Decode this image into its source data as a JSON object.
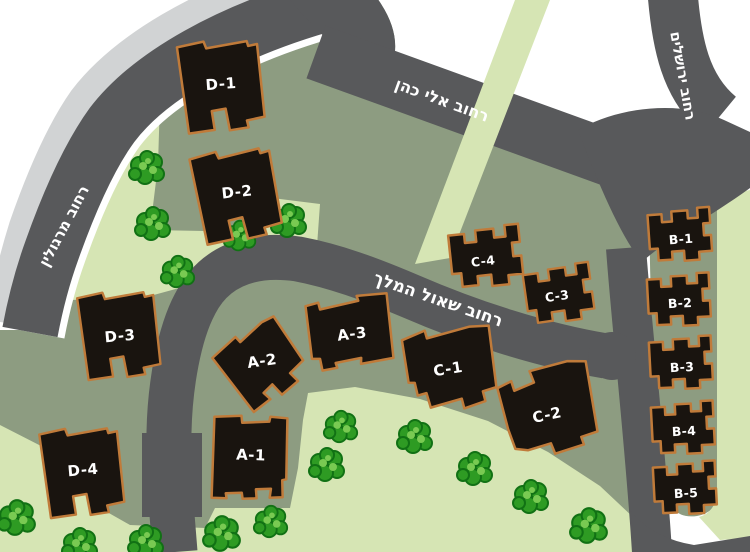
{
  "map_title": "site-plan",
  "streets": {
    "margolin": "רחוב מרגולין",
    "eli_cohen": "רחוב אלי כהן",
    "shaul_hamelech": "רחוב שאול המלך",
    "yerushalayim": "רחוב ירושלים"
  },
  "buildings": {
    "d1": "D-1",
    "d2": "D-2",
    "d3": "D-3",
    "d4": "D-4",
    "a1": "A-1",
    "a2": "A-2",
    "a3": "A-3",
    "c1": "C-1",
    "c2": "C-2",
    "c3": "C-3",
    "c4": "C-4",
    "b1": "B-1",
    "b2": "B-2",
    "b3": "B-3",
    "b4": "B-4",
    "b5": "B-5"
  },
  "colors": {
    "background": "#ffffff",
    "road": "#58595b",
    "road_edge": "#ffffff",
    "sidewalk": "#d1d3d4",
    "parcel": "#8d9c81",
    "path": "#d6e5b4",
    "building": "#19140f",
    "building_outline": "#c07b3a",
    "label_text": "#ffffff",
    "street_text": "#ffffff",
    "tree_dark": "#117114",
    "tree_mid": "#2e9b23",
    "tree_light": "#79ca52"
  }
}
